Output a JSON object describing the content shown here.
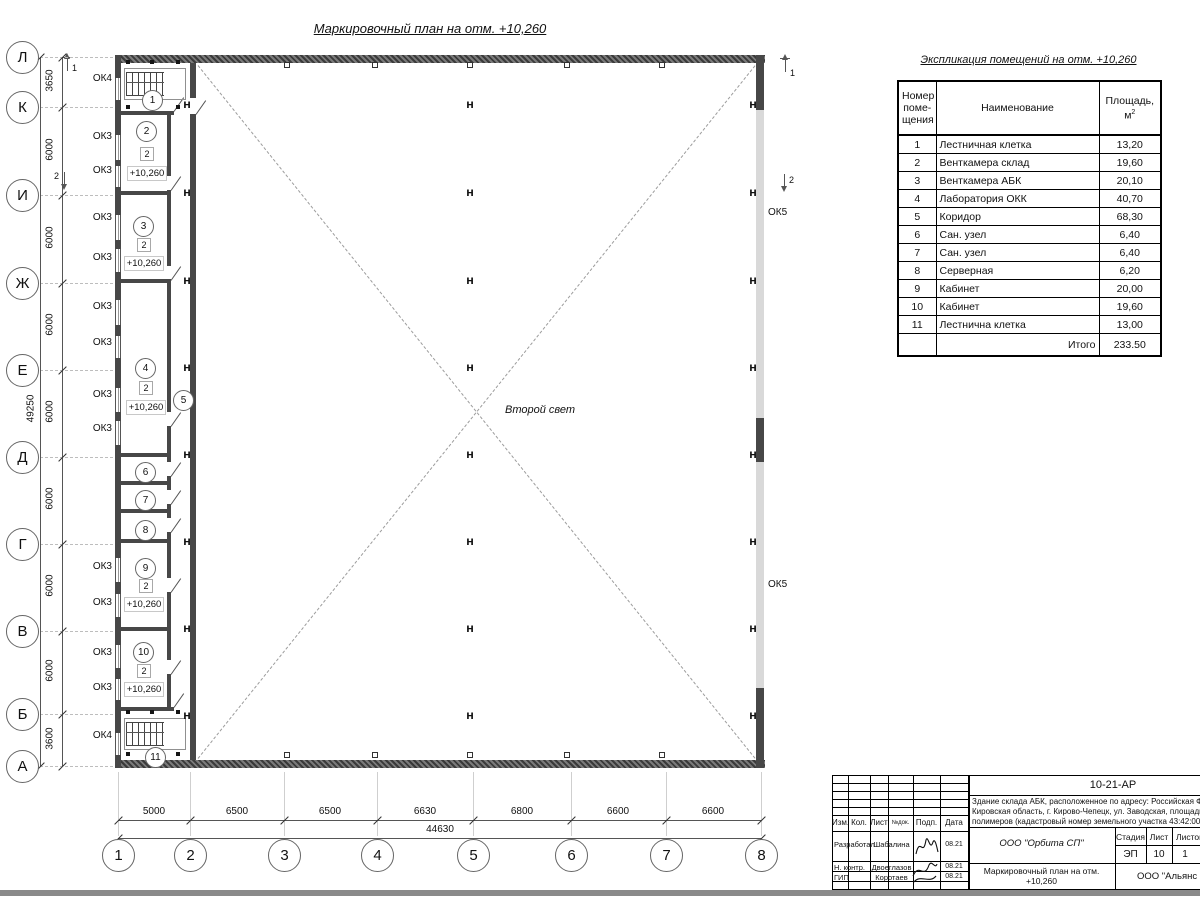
{
  "plan": {
    "title": "Маркировочный план на отм. +10,260",
    "second_light": "Второй свет",
    "rooms": [
      "1",
      "2",
      "3",
      "4",
      "5",
      "6",
      "7",
      "8",
      "9",
      "10",
      "11"
    ],
    "storey": "2",
    "elevation": "+10,260",
    "ok3": "ОК3",
    "ok4": "ОК4",
    "ok5": "ОК5",
    "column_mark": "Н",
    "section1": "1",
    "section2": "2"
  },
  "axes": {
    "letters": [
      "Л",
      "К",
      "И",
      "Ж",
      "Е",
      "Д",
      "Г",
      "В",
      "Б",
      "А"
    ],
    "numbers": [
      "1",
      "2",
      "3",
      "4",
      "5",
      "6",
      "7",
      "8"
    ],
    "left_dims": [
      "3650",
      "6000",
      "6000",
      "6000",
      "6000",
      "6000",
      "6000",
      "6000",
      "3600"
    ],
    "left_total": "49250",
    "bottom_dims": [
      "5000",
      "6500",
      "6500",
      "6630",
      "6800",
      "6600",
      "6600"
    ],
    "bottom_total": "44630"
  },
  "table": {
    "title": "Экспликация помещений на отм. +10,260",
    "header": {
      "num_l1": "Номер",
      "num_l2": "поме-",
      "num_l3": "щения",
      "name": "Наименование",
      "area_l1": "Площадь,",
      "area_base": "м",
      "area_sup": "2"
    },
    "rows": [
      {
        "num": "1",
        "name": "Лестничная клетка",
        "area": "13,20"
      },
      {
        "num": "2",
        "name": "Венткамера склад",
        "area": "19,60"
      },
      {
        "num": "3",
        "name": "Венткамера АБК",
        "area": "20,10"
      },
      {
        "num": "4",
        "name": "Лаборатория ОКК",
        "area": "40,70"
      },
      {
        "num": "5",
        "name": "Коридор",
        "area": "68,30"
      },
      {
        "num": "6",
        "name": "Сан. узел",
        "area": "6,40"
      },
      {
        "num": "7",
        "name": "Сан. узел",
        "area": "6,40"
      },
      {
        "num": "8",
        "name": "Серверная",
        "area": "6,20"
      },
      {
        "num": "9",
        "name": "Кабинет",
        "area": "20,00"
      },
      {
        "num": "10",
        "name": "Кабинет",
        "area": "19,60"
      },
      {
        "num": "11",
        "name": "Лестнична клетка",
        "area": "13,00"
      }
    ],
    "total_label": "Итого",
    "total_value": "233.50"
  },
  "title_block": {
    "doc_number": "10-21-АР",
    "address_l1": "Здание склада АБК, расположенное по адресу: Российская Феде",
    "address_l2": "Кировская область, г. Кирово-Чепецк, ул. Заводская, площадка з",
    "address_l3": "полимеров (кадастровый номер земельного участка 43:42:0000",
    "col_izm": "Изм.",
    "col_kol": "Кол.",
    "col_list": "Лист",
    "col_ndok": "№док.",
    "col_podp": "Подп.",
    "col_data": "Дата",
    "role1": "Разработал",
    "name1": "Шабалина",
    "date1": "08.21",
    "role2": "Н. контр.",
    "name2": "Двоеглазов",
    "date2": "08.21",
    "role3": "ГИП",
    "name3": "Коротаев",
    "date3": "08.21",
    "org": "ООО \"Орбита СП\"",
    "stage_label": "Стадия",
    "stage": "ЭП",
    "sheet_label": "Лист",
    "sheet": "10",
    "sheets_label": "Листов",
    "sheets": "1",
    "title_l1": "Маркировочный план на отм.",
    "title_l2": "+10,260",
    "company": "ООО \"Альянс"
  }
}
